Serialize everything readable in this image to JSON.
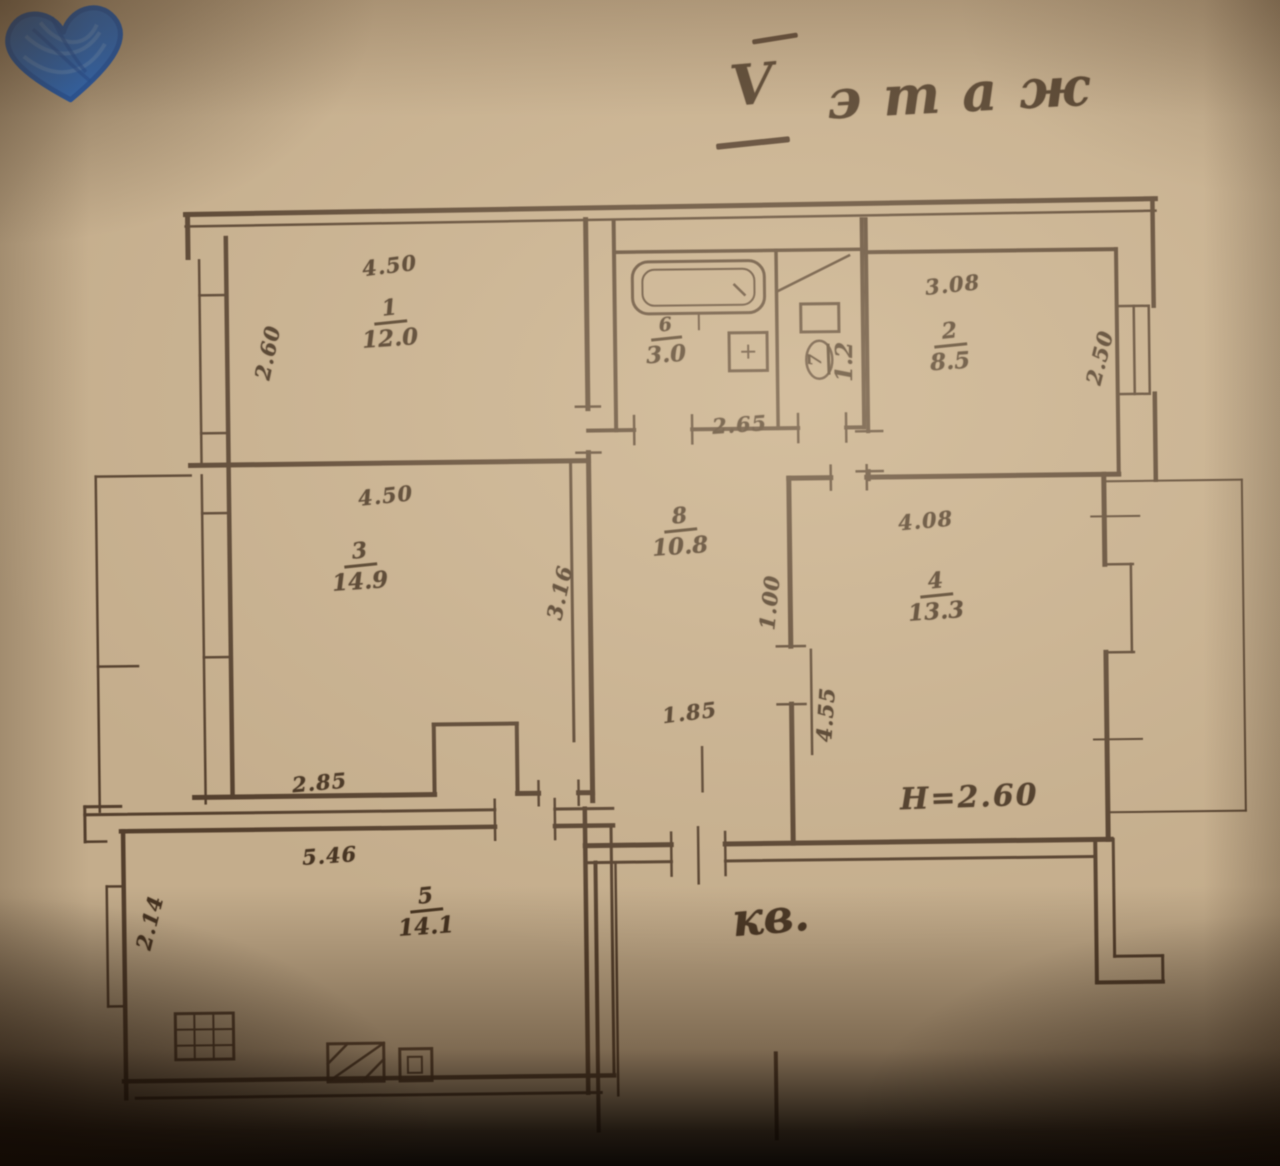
{
  "title": {
    "floor_numeral": "V",
    "floor_word": "этаж"
  },
  "annotations": {
    "apartment_label": "кв.",
    "height_note": "Н=2.60"
  },
  "rooms": [
    {
      "label": "room-1",
      "number": "1",
      "area": "12.0"
    },
    {
      "label": "room-2",
      "number": "2",
      "area": "8.5"
    },
    {
      "label": "room-3",
      "number": "3",
      "area": "14.9"
    },
    {
      "label": "room-4",
      "number": "4",
      "area": "13.3"
    },
    {
      "label": "kitchen",
      "number": "5",
      "area": "14.1"
    },
    {
      "label": "bathroom",
      "number": "6",
      "area": "3.0"
    },
    {
      "label": "wc",
      "number": "7",
      "area": "1.2"
    },
    {
      "label": "hall",
      "number": "8",
      "area": "10.8"
    }
  ],
  "dimensions": {
    "room1_width": "4.50",
    "room1_depth": "2.60",
    "room2_width": "3.08",
    "room2_depth": "2.50",
    "room3_width": "4.50",
    "room3_depth": "3.16",
    "room4_width": "4.08",
    "bathroom_width": "2.65",
    "hall_width": "1.85",
    "hall_door": "1.00",
    "hall_depth": "4.55",
    "room3_lower_width": "2.85",
    "kitchen_width": "5.46",
    "kitchen_depth": "2.14"
  }
}
